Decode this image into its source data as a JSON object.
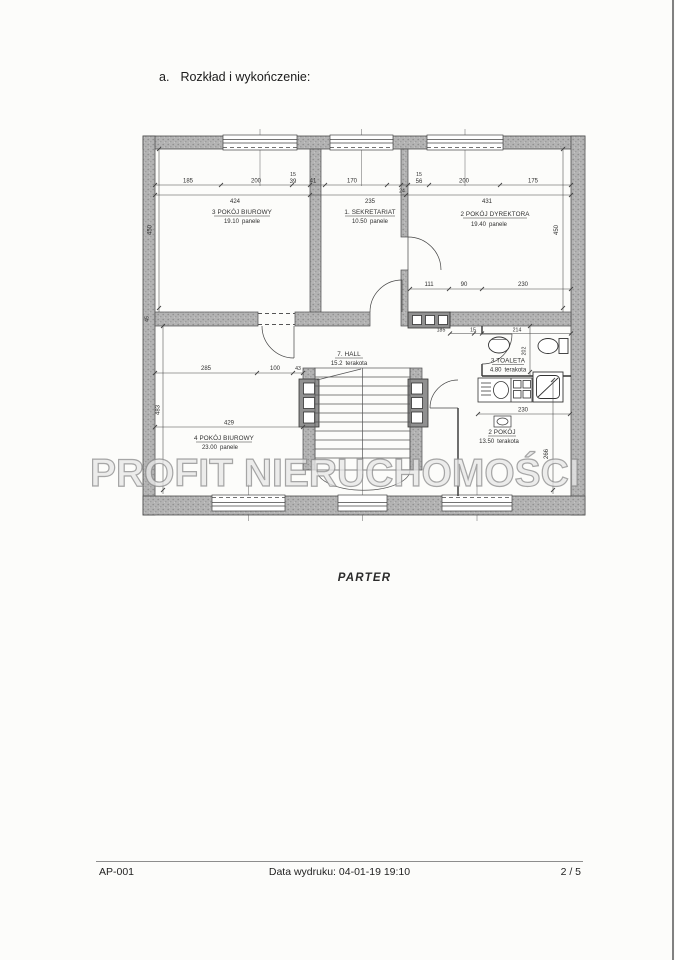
{
  "page": {
    "heading": {
      "letter": "a.",
      "text": "Rozkład i wykończenie:"
    },
    "watermark": "PROFIT NIERUCHOMOŚCI",
    "plan_caption": "PARTER"
  },
  "footer": {
    "doc_code": "AP-001",
    "print_info": "Data wydruku: 04-01-19 19:10",
    "page_num": "2 / 5"
  },
  "plan": {
    "rooms": [
      {
        "label": "3 POKÓJ BIUROWY",
        "area": "19.10",
        "finish": "panele"
      },
      {
        "label": "1. SEKRETARIAT",
        "area": "10.50",
        "finish": "panele"
      },
      {
        "label": "2 POKÓJ DYREKTORA",
        "area": "19.40",
        "finish": "panele"
      },
      {
        "label": "7. HALL",
        "area": "15.2",
        "finish": "terakota"
      },
      {
        "label": "3 TOALETA",
        "area": "4.80",
        "finish": "terakota"
      },
      {
        "label": "4 POKÓJ BIUROWY",
        "area": "23.00",
        "finish": "panele"
      },
      {
        "label": "2 POKÓJ",
        "area": "13.50",
        "finish": "terakota"
      }
    ],
    "dims": {
      "top1": [
        "185",
        "200",
        "15",
        "39",
        "41",
        "170",
        "24",
        "15",
        "56",
        "200",
        "175"
      ],
      "top2": [
        "424",
        "235",
        "431"
      ],
      "mid": [
        "111",
        "90",
        "230"
      ],
      "wc": [
        "185",
        "15",
        "214"
      ],
      "room4_top": [
        "285",
        "100",
        "43"
      ],
      "room4_width": "429",
      "room2_width": "230",
      "v_left_upper": "450",
      "v_left_mid": "45",
      "v_left_lower": "483",
      "v_right_upper": "450",
      "v_wc": "202",
      "v_right_lower": "266"
    }
  }
}
